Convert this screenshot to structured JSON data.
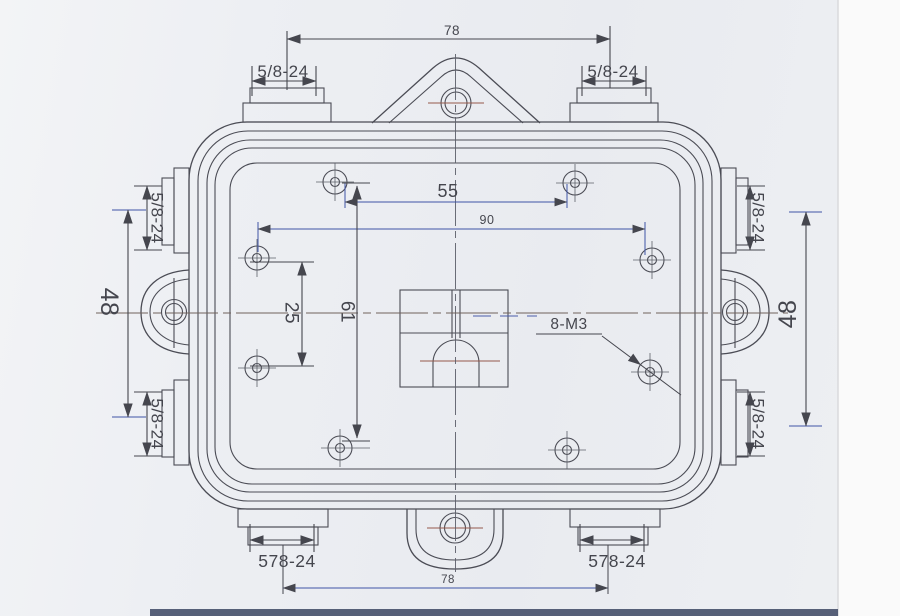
{
  "drawing": {
    "dimensions": {
      "top_span": "78",
      "hole_pitch_top": "55",
      "hole_pitch_middle": "90",
      "hole_gap_left": "25",
      "hole_span_vertical": "61",
      "port_pitch_left": "48",
      "port_pitch_right": "48",
      "tapped_holes_callout": "8-M3",
      "bottom_span": "78"
    },
    "ports": {
      "top_left": "5/8-24",
      "top_right": "5/8-24",
      "left_upper": "5/8-24",
      "left_lower": "5/8-24",
      "right_upper": "5/8-24",
      "right_lower": "5/8-24",
      "bottom_left": "578-24",
      "bottom_right": "578-24"
    },
    "colors": {
      "paper": "#edeff3",
      "ink": "#4b4c55",
      "dim_blue": "#3f54a6",
      "centerline_red": "#95594b"
    }
  }
}
